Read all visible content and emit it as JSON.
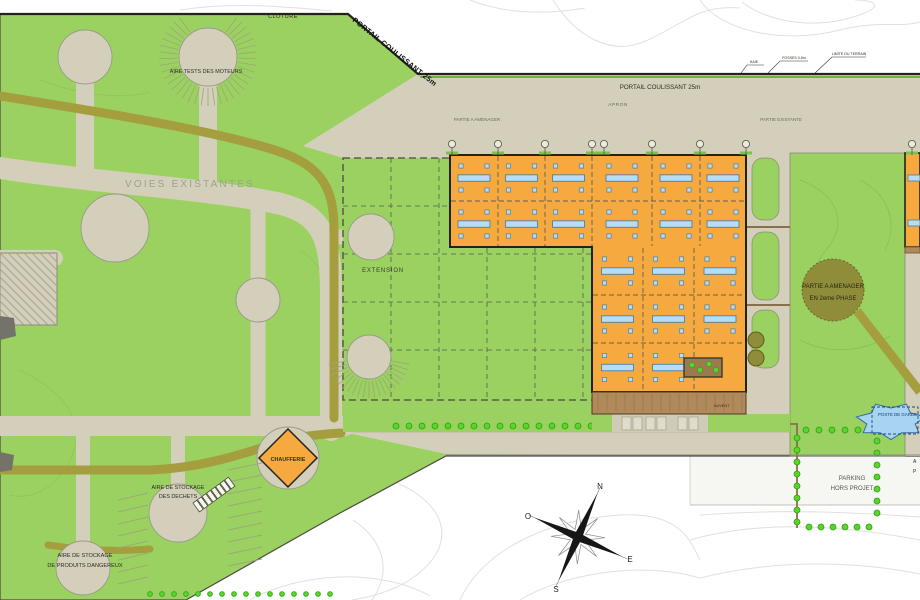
{
  "labels": {
    "cloture": "CLOTURE",
    "portail_coulissant_nw": "PORTAIL COULISSANT 25m",
    "portail_coulissant_n": "PORTAIL COULISSANT 25m",
    "haie": "HAIE",
    "fosses": "FOSSES 0.8m",
    "limite_terrain": "LIMITE DU TERRAIN",
    "apron": "APRON",
    "partie_a_amenager": "PARTIE A AMENAGER",
    "partie_existante": "PARTIE EXISTANTE",
    "voies_existantes": "VOIES EXISTANTES",
    "extension": "EXTENSION",
    "aire_tests_moteurs": "AIRE TESTS DES MOTEURS",
    "chaufferie": "CHAUFFERIE",
    "stockage_dechets_line1": "AIRE DE STOCKAGE",
    "stockage_dechets_line2": "DES DECHETS",
    "stockage_dangereux_line1": "AIRE DE STOCKAGE",
    "stockage_dangereux_line2": "DE PRODUITS DANGEREUX",
    "phase2_line1": "PARTIE A AMENAGER",
    "phase2_line2": "EN 2eme PHASE",
    "poste_de_garde": "POSTE DE GARDE",
    "parking_line1": "PARKING",
    "parking_line2": "HORS PROJET",
    "auvent": "AUVENT",
    "edge_label_a": "A",
    "edge_label_p": "P"
  },
  "compass": {
    "north": "N",
    "east": "E",
    "south": "S",
    "west": "O"
  },
  "colors": {
    "grass": "#9bd160",
    "pavement": "#d3cfba",
    "olive_band": "#a49e3f",
    "building_orange": "#f6a93e",
    "skylight_blue": "#b7dcf4",
    "dock_brown": "#b18a5c",
    "hedge_green": "#58d42c",
    "pond_blue": "#a8d4f2",
    "contour_gray": "#e0e0dc",
    "outline_dark": "#23231c"
  }
}
